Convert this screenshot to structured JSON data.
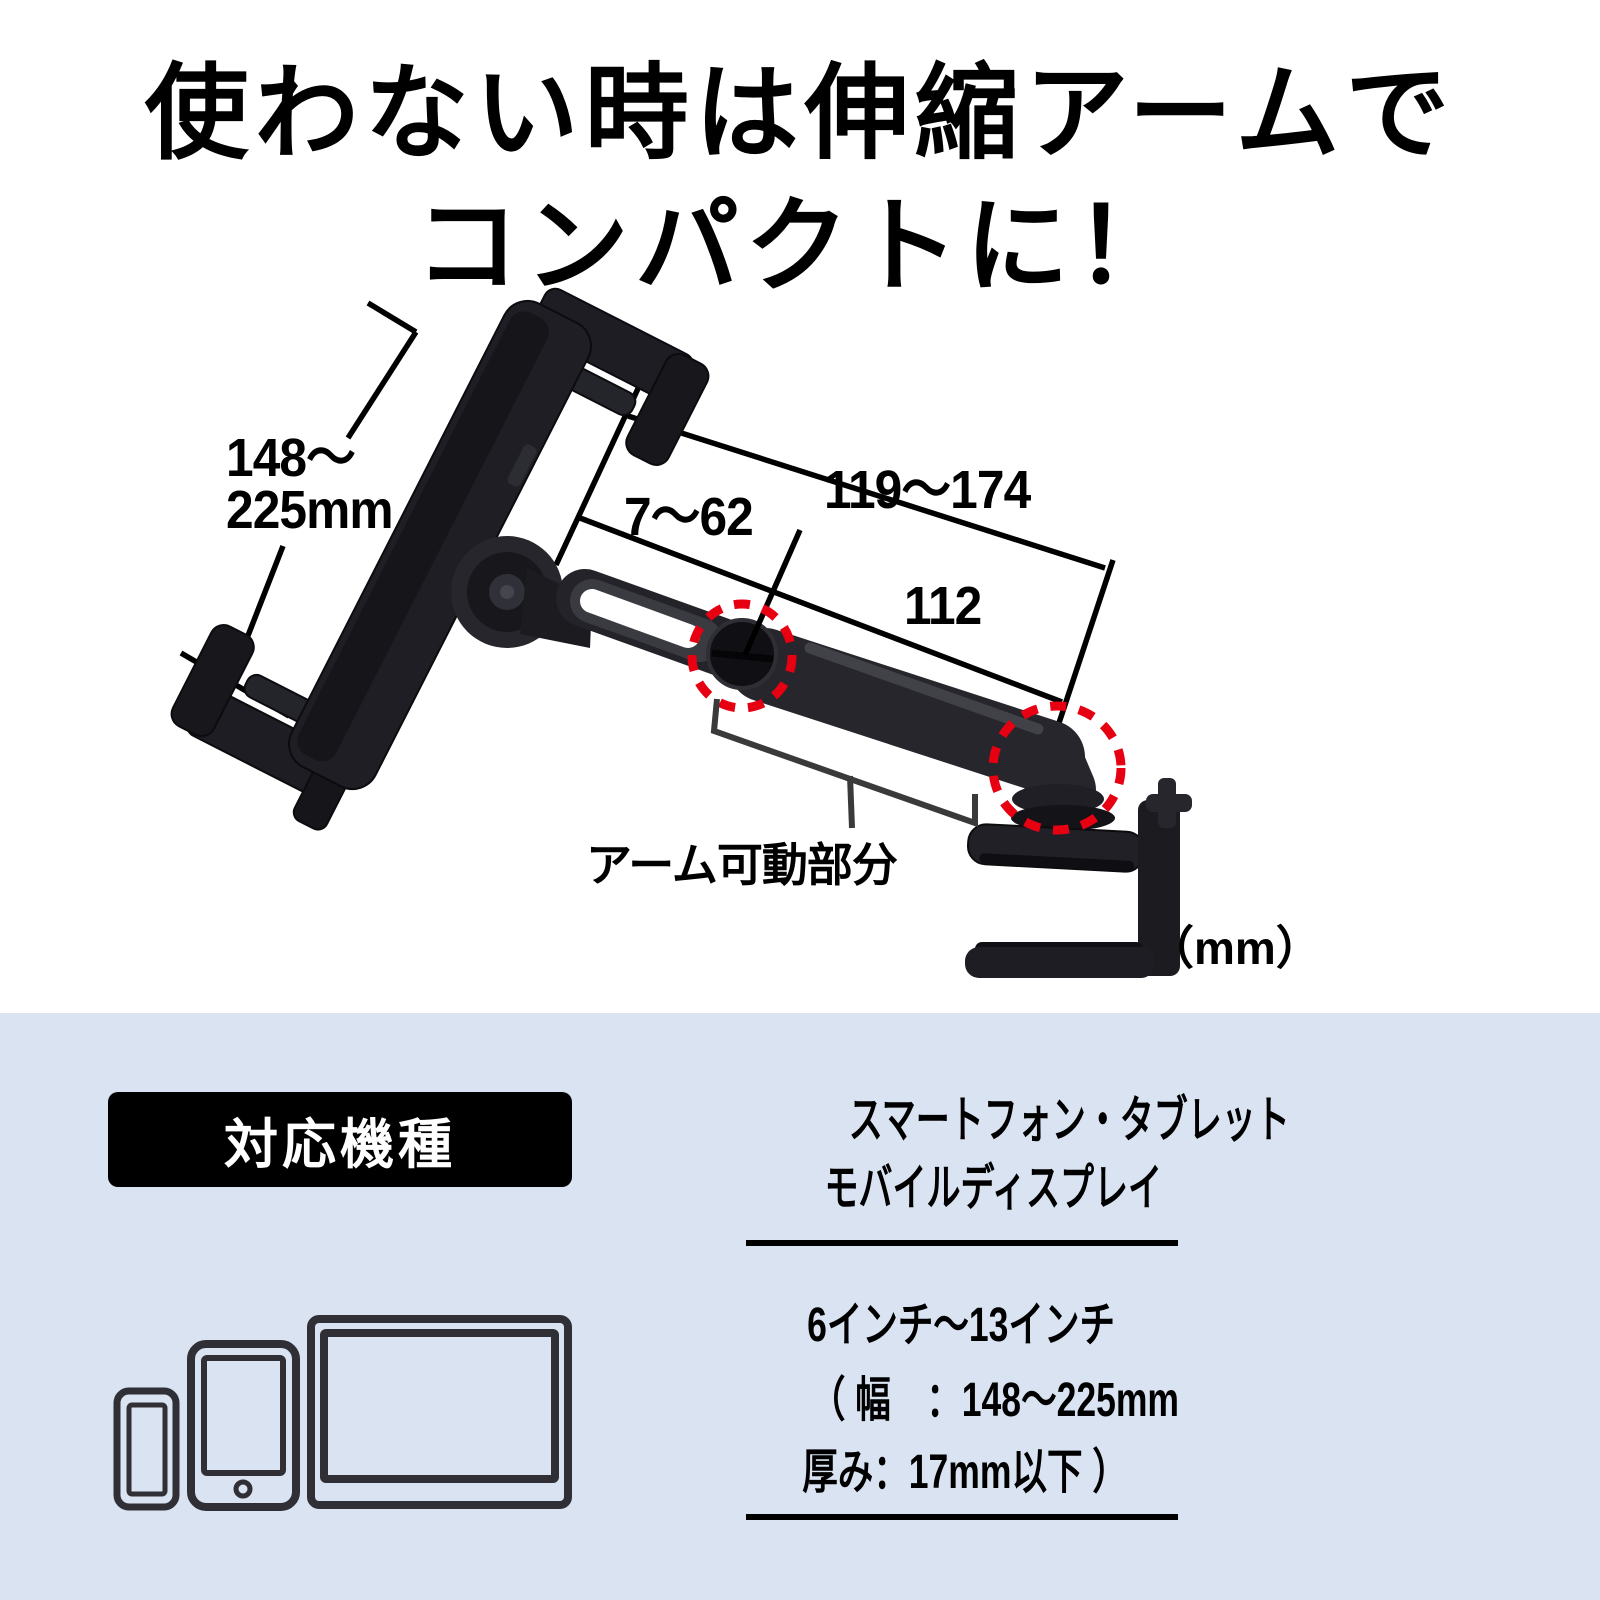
{
  "title": {
    "line1": "使わない時は伸縮アームで",
    "line2": "コンパクトに！"
  },
  "diagram": {
    "accent_red": "#e60012",
    "labels": {
      "width_range_line1": "148～",
      "width_range_line2": "225mm",
      "slide_range": "7～62",
      "arm_extend_range": "119～174",
      "arm_length": "112",
      "arm_movable": "アーム可動部分",
      "unit": "（mm）"
    }
  },
  "compat": {
    "bg": "#d9e3f1",
    "badge": "対応機種",
    "device_types_line1": "スマートフォン・タブレット",
    "device_types_line2": "モバイルディスプレイ",
    "size_range": "6インチ～13インチ",
    "spec_width": "（ 幅　：148～225mm",
    "spec_thickness": "厚み：17mm以下 ）",
    "icons": [
      "smartphone-icon",
      "tablet-icon",
      "monitor-icon"
    ]
  }
}
